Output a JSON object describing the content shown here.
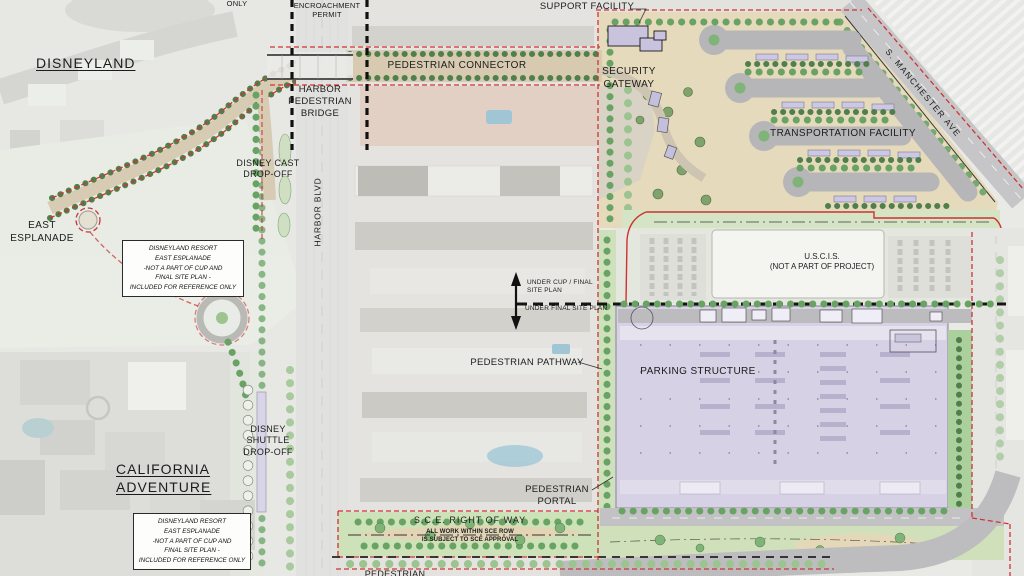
{
  "plan": {
    "labels": {
      "reference_only": "REFERENCE\nONLY",
      "encroachment_permit": "ENCROACHMENT\nPERMIT",
      "disneyland": "DISNEYLAND",
      "harbor_pedestrian_bridge": "HARBOR\nPEDESTRIAN\nBRIDGE",
      "pedestrian_connector": "PEDESTRIAN CONNECTOR",
      "support_facility": "SUPPORT FACILITY",
      "security_gateway": "SECURITY\nGATEWAY",
      "transportation_facility": "TRANSPORTATION FACILITY",
      "s_manchester_ave": "S. MANCHESTER AVE",
      "east_esplanade": "EAST\nESPLANADE",
      "disney_cast_drop_off": "DISNEY CAST\nDROP-OFF",
      "harbor_blvd": "HARBOR BLVD",
      "uscis": "U.S.C.I.S.\n(NOT A PART OF PROJECT)",
      "under_cup_final": "UNDER CUP / FINAL\nSITE PLAN",
      "under_final": "UNDER FINAL SITE PLAN",
      "pedestrian_pathway": "PEDESTRIAN PATHWAY",
      "parking_structure": "PARKING STRUCTURE",
      "pedestrian_portal": "PEDESTRIAN\nPORTAL",
      "sce_right_of_way": "S.C.E. RIGHT OF WAY",
      "sce_note": "ALL WORK WITHIN SCE ROW\nIS SUBJECT TO SCE APPROVAL",
      "disney_shuttle_drop_off": "DISNEY\nSHUTTLE\nDROP-OFF",
      "california_adventure": "CALIFORNIA\nADVENTURE",
      "pedestrian_partial": "PEDESTRIAN"
    },
    "note_boxes": {
      "east_esplanade_note_upper": "DISNEYLAND RESORT\nEAST ESPLANADE\n-NOT A PART OF CUP AND\nFINAL SITE PLAN -\nINCLUDED FOR REFERENCE ONLY",
      "east_esplanade_note_lower": "DISNEYLAND RESORT\nEAST ESPLANADE\n-NOT A PART OF CUP AND\nFINAL SITE PLAN -\nINCLUDED FOR REFERENCE ONLY"
    },
    "colors": {
      "boundary_red": "#cf3434",
      "project_tan": "#e6dabc",
      "parking_lavender": "#d6d1e4",
      "shelter_lavender": "#ccc8e3",
      "road_gray": "#b6b6b9",
      "tree_green": "#68a364",
      "lawn_green": "#cfe0bc",
      "sce_green": "#cde2b8"
    }
  }
}
